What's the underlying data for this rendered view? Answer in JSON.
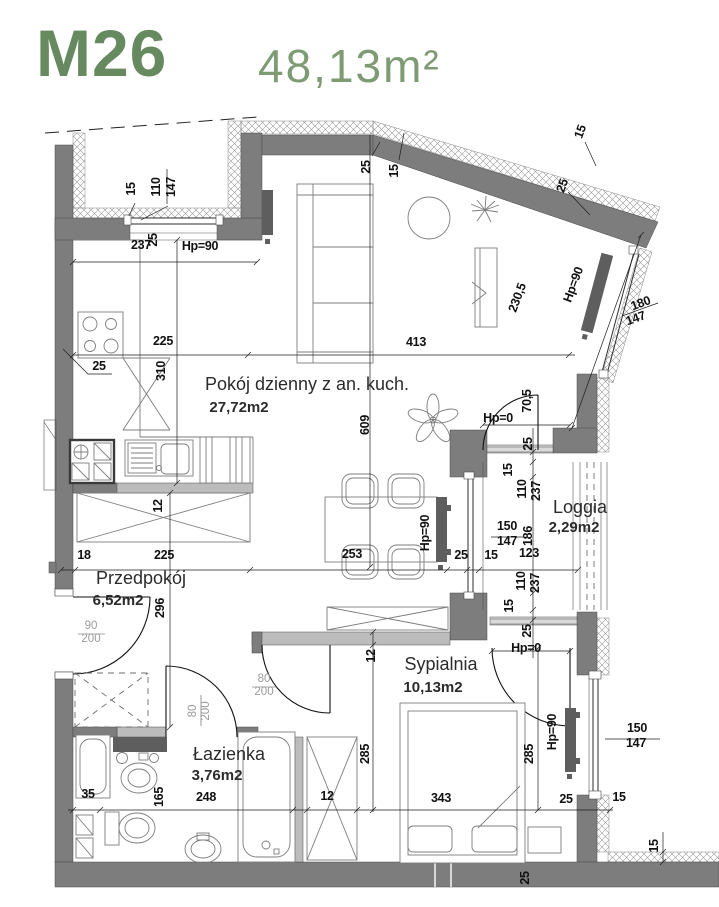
{
  "title": {
    "unit": "M26",
    "area": "48,13m²"
  },
  "colors": {
    "accent": "#67895f",
    "accent_light": "#7e9b74",
    "wall": "#7d7d7d",
    "partition": "#bcbcbc",
    "radiator": "#5e5e5e"
  },
  "rooms": [
    {
      "name": "Pokój dzienny z an. kuch.",
      "area": "27,72m2",
      "nx": 307,
      "ny": 390,
      "ax": 239,
      "ay": 412
    },
    {
      "name": "Przedpokój",
      "area": "6,52m2",
      "nx": 141,
      "ny": 584,
      "ax": 118,
      "ay": 605
    },
    {
      "name": "Łazienka",
      "area": "3,76m2",
      "nx": 229,
      "ny": 760,
      "ax": 217,
      "ay": 780
    },
    {
      "name": "Sypialnia",
      "area": "10,13m2",
      "nx": 441,
      "ny": 670,
      "ax": 433,
      "ay": 692
    },
    {
      "name": "Loggia",
      "area": "2,29m2",
      "nx": 580,
      "ny": 513,
      "ax": 574,
      "ay": 532
    }
  ],
  "dims": [
    {
      "t": "15",
      "x": 135,
      "y": 189,
      "r": -90
    },
    {
      "t": "110",
      "x": 160,
      "y": 187,
      "r": -90
    },
    {
      "t": "147",
      "x": 175,
      "y": 187,
      "r": -90
    },
    {
      "t": "25",
      "x": 157,
      "y": 240,
      "r": -90
    },
    {
      "t": "237",
      "x": 141,
      "y": 249,
      "r": 0
    },
    {
      "t": "Hp=90",
      "x": 200,
      "y": 250,
      "r": 0
    },
    {
      "t": "25",
      "x": 99,
      "y": 370,
      "r": 0
    },
    {
      "t": "225",
      "x": 163,
      "y": 345,
      "r": 0
    },
    {
      "t": "413",
      "x": 416,
      "y": 346,
      "r": 0
    },
    {
      "t": "310",
      "x": 165,
      "y": 371,
      "r": -90
    },
    {
      "t": "25",
      "x": 370,
      "y": 167,
      "r": -90
    },
    {
      "t": "15",
      "x": 398,
      "y": 171,
      "r": -90
    },
    {
      "t": "15",
      "x": 584,
      "y": 133,
      "r": -70
    },
    {
      "t": "25",
      "x": 566,
      "y": 187,
      "r": -70
    },
    {
      "t": "230,5",
      "x": 521,
      "y": 299,
      "r": -70
    },
    {
      "t": "Hp=90",
      "x": 577,
      "y": 286,
      "r": -70
    },
    {
      "t": "180",
      "x": 642,
      "y": 307,
      "r": -20
    },
    {
      "t": "147",
      "x": 637,
      "y": 322,
      "r": -20
    },
    {
      "t": "609",
      "x": 369,
      "y": 425,
      "r": -90
    },
    {
      "t": "12",
      "x": 162,
      "y": 506,
      "r": -90
    },
    {
      "t": "Hp=90",
      "x": 429,
      "y": 533,
      "r": -90
    },
    {
      "t": "18",
      "x": 84,
      "y": 559,
      "r": 0
    },
    {
      "t": "225",
      "x": 164,
      "y": 559,
      "r": 0
    },
    {
      "t": "253",
      "x": 352,
      "y": 558,
      "r": 0
    },
    {
      "t": "25",
      "x": 461,
      "y": 559,
      "r": 0
    },
    {
      "t": "15",
      "x": 491,
      "y": 559,
      "r": 0
    },
    {
      "t": "123",
      "x": 529,
      "y": 557,
      "r": 0
    },
    {
      "t": "296",
      "x": 164,
      "y": 608,
      "r": -90
    },
    {
      "t": "Hp=0",
      "x": 498,
      "y": 422,
      "r": 0
    },
    {
      "t": "70,5",
      "x": 531,
      "y": 401,
      "r": -90
    },
    {
      "t": "25",
      "x": 532,
      "y": 444,
      "r": -90
    },
    {
      "t": "15",
      "x": 512,
      "y": 470,
      "r": -90
    },
    {
      "t": "110",
      "x": 526,
      "y": 489,
      "r": -90
    },
    {
      "t": "237",
      "x": 540,
      "y": 491,
      "r": -90
    },
    {
      "t": "150",
      "x": 507,
      "y": 530,
      "r": 0
    },
    {
      "t": "147",
      "x": 507,
      "y": 545,
      "r": 0
    },
    {
      "t": "186",
      "x": 532,
      "y": 536,
      "r": -90
    },
    {
      "t": "110",
      "x": 525,
      "y": 581,
      "r": -90
    },
    {
      "t": "237",
      "x": 539,
      "y": 583,
      "r": -90
    },
    {
      "t": "15",
      "x": 513,
      "y": 606,
      "r": -90
    },
    {
      "t": "25",
      "x": 531,
      "y": 631,
      "r": -90
    },
    {
      "t": "Hp=0",
      "x": 526,
      "y": 652,
      "r": 0
    },
    {
      "t": "12",
      "x": 375,
      "y": 656,
      "r": -90
    },
    {
      "t": "285",
      "x": 369,
      "y": 754,
      "r": -90
    },
    {
      "t": "285",
      "x": 533,
      "y": 754,
      "r": -90
    },
    {
      "t": "343",
      "x": 441,
      "y": 802,
      "r": 0
    },
    {
      "t": "35",
      "x": 88,
      "y": 798,
      "r": 0
    },
    {
      "t": "165",
      "x": 163,
      "y": 797,
      "r": -90
    },
    {
      "t": "248",
      "x": 206,
      "y": 801,
      "r": 0
    },
    {
      "t": "12",
      "x": 327,
      "y": 800,
      "r": 0
    },
    {
      "t": "25",
      "x": 566,
      "y": 803,
      "r": 0
    },
    {
      "t": "15",
      "x": 619,
      "y": 801,
      "r": 0
    },
    {
      "t": "Hp=90",
      "x": 556,
      "y": 732,
      "r": -90
    },
    {
      "t": "150",
      "x": 637,
      "y": 732,
      "r": 0
    },
    {
      "t": "147",
      "x": 636,
      "y": 747,
      "r": 0
    },
    {
      "t": "25",
      "x": 529,
      "y": 878,
      "r": -90
    },
    {
      "t": "15",
      "x": 658,
      "y": 846,
      "r": -90
    }
  ],
  "door_labels": [
    {
      "t": "90",
      "x": 91,
      "y": 629,
      "r": 0
    },
    {
      "t": "200",
      "x": 91,
      "y": 642,
      "r": 0
    },
    {
      "t": "80",
      "x": 264,
      "y": 682,
      "r": 0
    },
    {
      "t": "200",
      "x": 264,
      "y": 695,
      "r": 0
    },
    {
      "t": "80",
      "x": 196,
      "y": 711,
      "r": -90
    },
    {
      "t": "200",
      "x": 209,
      "y": 711,
      "r": -90
    }
  ]
}
